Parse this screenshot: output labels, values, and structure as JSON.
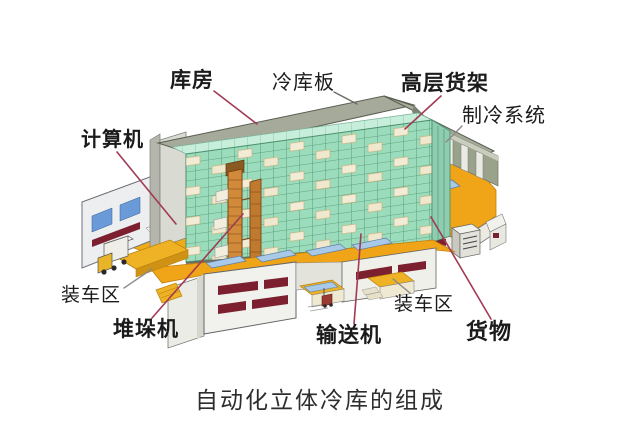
{
  "title": "自动化立体冷库的组成",
  "labels": {
    "kufang": "库房",
    "lengkuban": "冷库板",
    "gaocenghuojia": "高层货架",
    "zhilengxitong": "制冷系统",
    "jisuanji": "计算机",
    "zhuangchequ_left": "装车区",
    "duiduoji": "堆垛机",
    "shusongji": "输送机",
    "zhuangchequ_right": "装车区",
    "huowu": "货物"
  },
  "colors": {
    "racking_green": "#97dcba",
    "racking_top_green": "#c6eeda",
    "racking_outline_green": "#4e8f6e",
    "floor_orange": "#f0a418",
    "roof_gray": "#a6aa9a",
    "wall_white": "#f1f1ed",
    "dock_slot_maroon": "#7c2030",
    "window_blue": "#5b8fd0",
    "conveyor_blue": "#a9c9e9",
    "crane_orange": "#d08a3a",
    "goods_cream": "#efe8cf",
    "leader_red": "#a23a54",
    "leader_gray": "#8a8a86",
    "text_black": "#1b1b1b"
  }
}
